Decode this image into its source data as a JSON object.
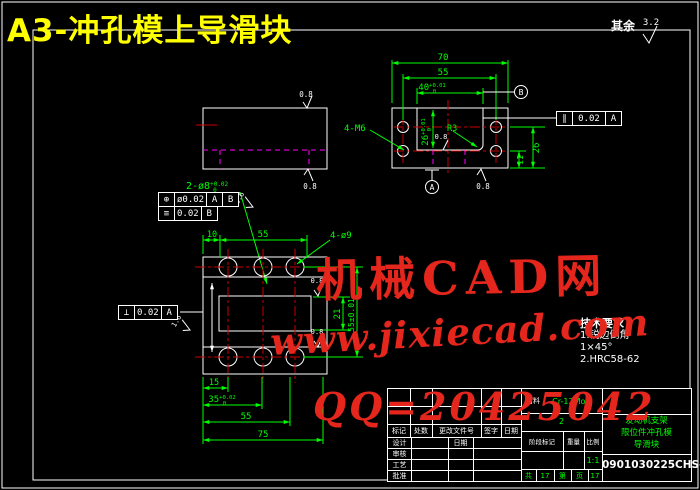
{
  "title": "A3-冲孔模上导滑块",
  "surplus": {
    "label": "其余",
    "value": "3.2"
  },
  "wm": {
    "l1": "机械CAD网",
    "l2": "www.jixiecad.com",
    "l3": "QQ=20425042"
  },
  "colors": {
    "dim_green": "#00ff00",
    "center_red": "#cc0000",
    "hidden_magenta": "#ff00ff",
    "title_yellow": "#ffff00",
    "watermark_red": "#e5261d"
  },
  "sv": {
    "rough_top": "0.8",
    "rough_bottom": "0.8"
  },
  "tv": {
    "d70": "70",
    "d55": "55",
    "d40": "40",
    "d40su": "+0.01",
    "d40sd": "0",
    "d26": "26",
    "d26su": "+0.01",
    "d26sd": "0",
    "r3": "R3",
    "rough": "0.8",
    "rough_br": "0.8",
    "d26r": "26",
    "d11": "11",
    "m6": "4-M6",
    "dA": "A",
    "dB": "B",
    "fcf": {
      "sym": "∥",
      "val": "0.02",
      "dat": "A"
    }
  },
  "mid": {
    "label": "2-ø8",
    "sup": "+0.02",
    "sub": "0",
    "rough": "1.6",
    "fcf1": {
      "sym": "⊕",
      "val": "ø0.02",
      "d1": "A",
      "d2": "B"
    },
    "fcf2": {
      "sym": "≡",
      "val": "0.02",
      "d1": "B"
    }
  },
  "fv": {
    "d10": "10",
    "d55t": "55",
    "d4d9": "4-ø9",
    "d21": "21",
    "d55r": "55±0.01",
    "d15": "15",
    "d35": "35",
    "d35su": "+0.02",
    "d35sd": "0",
    "d55b": "55",
    "d75": "75",
    "r1": "0.8",
    "r2": "0.8",
    "rough": "1.6",
    "fcf": {
      "sym": "⊥",
      "val": "0.02",
      "dat": "A"
    }
  },
  "tech": {
    "t": "技术要求",
    "l1": "1.锐边倒角",
    "l2": "1×45°",
    "l3": "2.HRC58-62"
  },
  "tb": {
    "material_label": "材料",
    "material": "Cr-12MoV",
    "qty": "2",
    "h1": "标记",
    "h2": "处数",
    "h3": "更改文件号",
    "h4": "签字",
    "h5": "日期",
    "r1": "设计",
    "r2": "审核",
    "r3": "工艺",
    "r4": "批准",
    "date": "日期",
    "stage": "阶段标记",
    "weight": "重量",
    "scale_l": "比例",
    "scale": "1:1",
    "s1": "共",
    "s2": "17",
    "s3": "第",
    "s4": "页",
    "s5": "17",
    "name1": "发动机支架",
    "name2": "限位件冲孔模",
    "name3": "导滑块",
    "no": "0901030225CHS-16"
  }
}
